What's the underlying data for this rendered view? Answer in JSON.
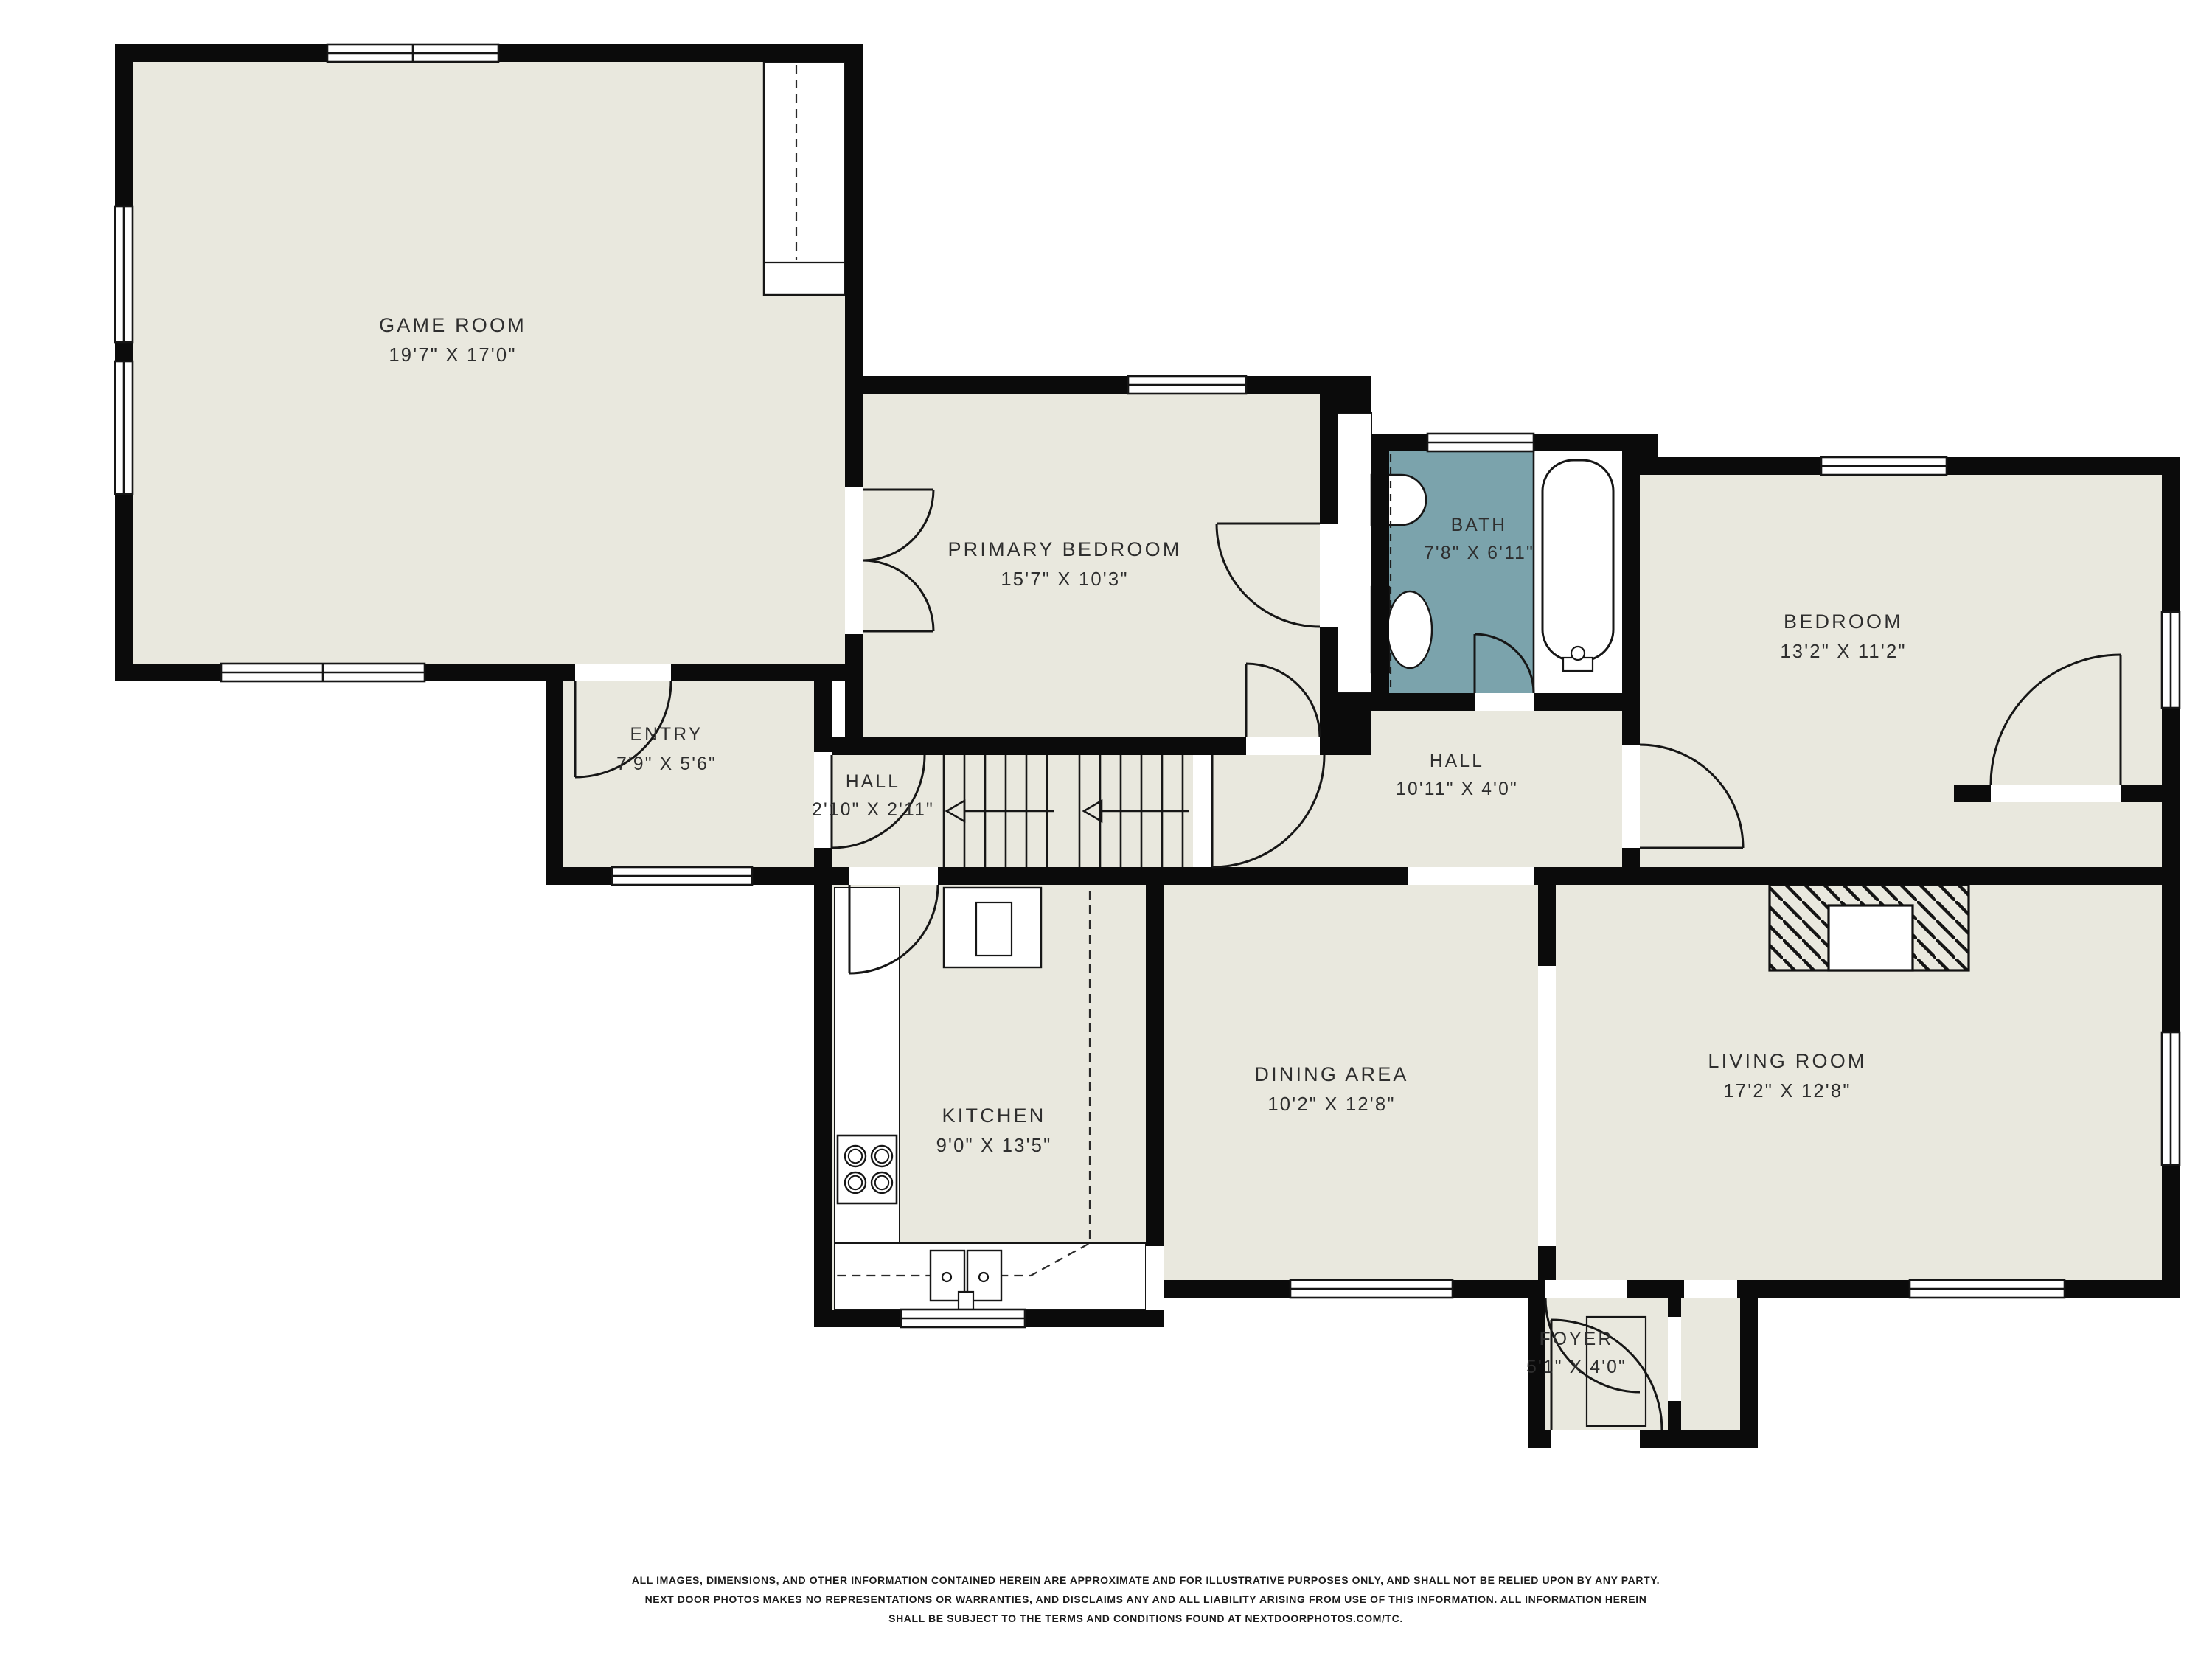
{
  "colors": {
    "floor": "#e9e8de",
    "bath_floor": "#7ba3ac",
    "wall": "#0b0b0b",
    "line": "#161616",
    "text": "#2e2e2e",
    "background": "#ffffff"
  },
  "rooms": [
    {
      "id": "game-room",
      "name": "GAME ROOM",
      "dims": "19'7\" X 17'0\""
    },
    {
      "id": "primary-bedroom",
      "name": "PRIMARY BEDROOM",
      "dims": "15'7\" X 10'3\""
    },
    {
      "id": "bath",
      "name": "BATH",
      "dims": "7'8\" X 6'11\""
    },
    {
      "id": "bedroom",
      "name": "BEDROOM",
      "dims": "13'2\" X 11'2\""
    },
    {
      "id": "entry",
      "name": "ENTRY",
      "dims": "7'9\" X 5'6\""
    },
    {
      "id": "hall-small",
      "name": "HALL",
      "dims": "2'10\" X 2'11\""
    },
    {
      "id": "hall",
      "name": "HALL",
      "dims": "10'11\" X 4'0\""
    },
    {
      "id": "kitchen",
      "name": "KITCHEN",
      "dims": "9'0\" X 13'5\""
    },
    {
      "id": "dining-area",
      "name": "DINING AREA",
      "dims": "10'2\" X 12'8\""
    },
    {
      "id": "living-room",
      "name": "LIVING ROOM",
      "dims": "17'2\" X 12'8\""
    },
    {
      "id": "foyer",
      "name": "FOYER",
      "dims": "5'1\" X 4'0\""
    }
  ],
  "disclaimer": {
    "line1": "ALL IMAGES, DIMENSIONS, AND OTHER INFORMATION CONTAINED HEREIN ARE APPROXIMATE AND FOR ILLUSTRATIVE PURPOSES ONLY, AND SHALL NOT BE RELIED UPON BY ANY PARTY.",
    "line2": "NEXT DOOR PHOTOS MAKES NO REPRESENTATIONS OR WARRANTIES, AND DISCLAIMS ANY AND ALL LIABILITY ARISING FROM USE OF THIS INFORMATION. ALL INFORMATION HEREIN",
    "line3": "SHALL BE SUBJECT TO THE TERMS AND CONDITIONS FOUND AT NEXTDOORPHOTOS.COM/TC."
  }
}
